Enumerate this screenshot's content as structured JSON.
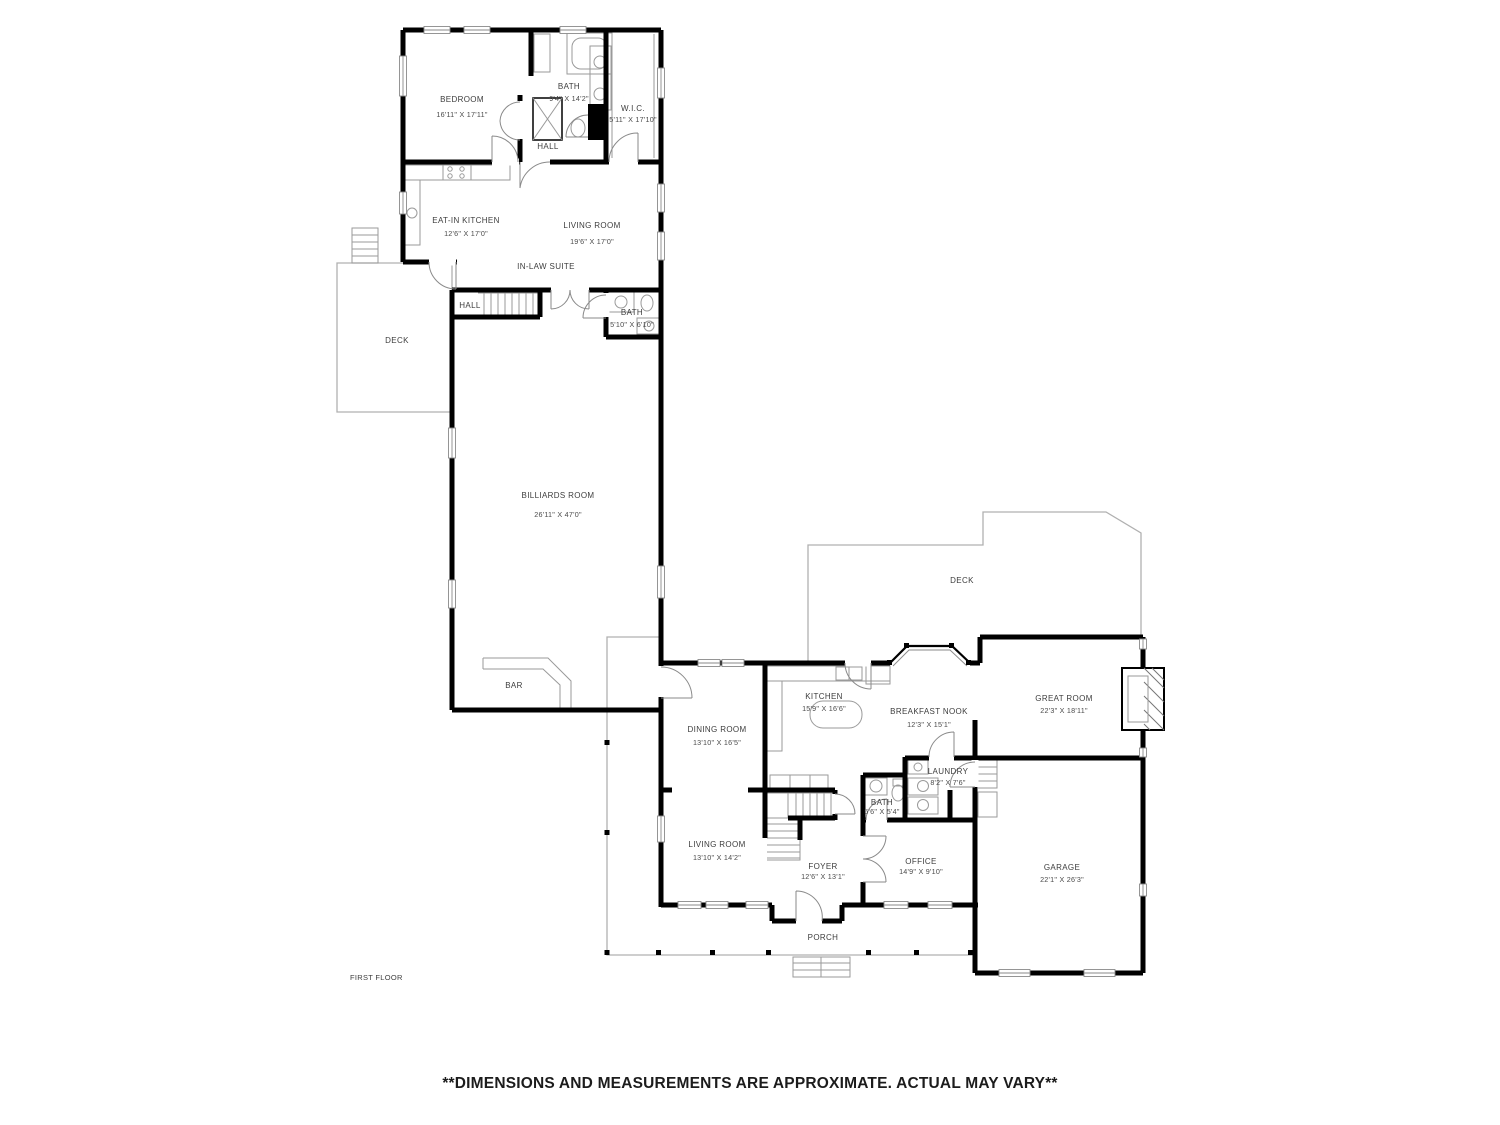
{
  "plan": {
    "floor_label": "FIRST FLOOR",
    "disclaimer": "**DIMENSIONS AND MEASUREMENTS ARE APPROXIMATE. ACTUAL MAY VARY**",
    "colors": {
      "wall": "#000000",
      "thin_line": "#9a9a9a",
      "label_text": "#3d3d3d",
      "background": "#ffffff"
    },
    "rooms": {
      "bedroom": {
        "name": "BEDROOM",
        "dims": "16'11\" X 17'11\""
      },
      "bath_top": {
        "name": "BATH",
        "dims": "9'4\" X 14'2\""
      },
      "wic": {
        "name": "W.I.C.",
        "dims": "5'11\" X 17'10\""
      },
      "hall_top": {
        "name": "HALL"
      },
      "eat_in_kitchen": {
        "name": "EAT-IN KITCHEN",
        "dims": "12'6\" X 17'0\""
      },
      "living_room_inlaw": {
        "name": "LIVING ROOM",
        "dims": "19'6\" X 17'0\""
      },
      "in_law_suite": {
        "name": "IN-LAW SUITE"
      },
      "hall_mid": {
        "name": "HALL"
      },
      "bath_inlaw": {
        "name": "BATH",
        "dims": "5'10\" X 6'10\""
      },
      "deck_left": {
        "name": "DECK"
      },
      "billiards": {
        "name": "BILLIARDS ROOM",
        "dims": "26'11\" X 47'0\""
      },
      "bar": {
        "name": "BAR"
      },
      "deck_right": {
        "name": "DECK"
      },
      "kitchen": {
        "name": "KITCHEN",
        "dims": "15'9\" X 16'6\""
      },
      "breakfast_nook": {
        "name": "BREAKFAST NOOK",
        "dims": "12'3\" X 15'1\""
      },
      "great_room": {
        "name": "GREAT ROOM",
        "dims": "22'3\" X 18'11\""
      },
      "dining_room": {
        "name": "DINING ROOM",
        "dims": "13'10\" X 16'5\""
      },
      "laundry": {
        "name": "LAUNDRY",
        "dims": "8'2\" X 7'6\""
      },
      "bath_half": {
        "name": "BATH",
        "dims": "5'6\" X 5'4\""
      },
      "living_room": {
        "name": "LIVING ROOM",
        "dims": "13'10\" X 14'2\""
      },
      "foyer": {
        "name": "FOYER",
        "dims": "12'6\" X 13'1\""
      },
      "office": {
        "name": "OFFICE",
        "dims": "14'9\" X 9'10\""
      },
      "garage": {
        "name": "GARAGE",
        "dims": "22'1\" X 26'3\""
      },
      "porch": {
        "name": "PORCH"
      }
    }
  }
}
